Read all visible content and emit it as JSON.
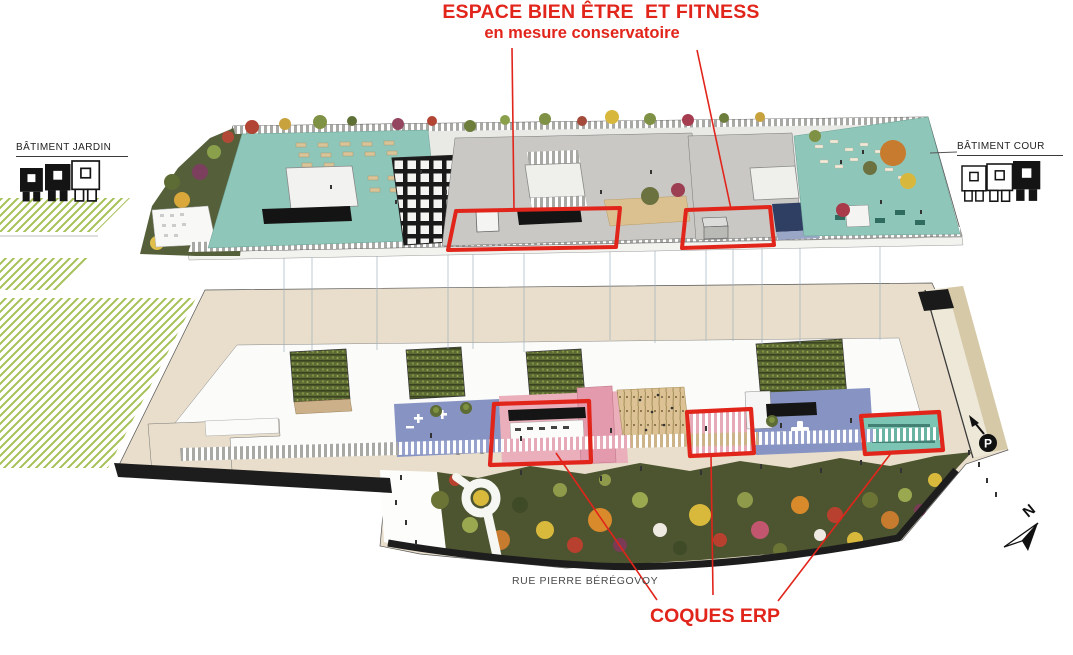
{
  "title": {
    "line1": "ESPACE BIEN ÊTRE  ET FITNESS",
    "line2": "en mesure conservatoire"
  },
  "buildings": {
    "left": "BÂTIMENT JARDIN",
    "right": "BÂTIMENT COUR"
  },
  "street_label": "RUE PIERRE BÉRÉGOVOY",
  "coques_label": "COQUES ERP",
  "compass": {
    "north": "N"
  },
  "parking": {
    "label": "P"
  },
  "colors": {
    "annotation_red": "#e1251b",
    "teal_terrace": "#8fc6ba",
    "gray_roof": "#c9c8c4",
    "plate_beige": "#e8decb",
    "blue_floor": "#8794c3",
    "pink_floor": "#eaafbb",
    "tan_floor": "#dcc294",
    "garden_green": "#4c5430",
    "hatch_green": "#a5c055",
    "blue_skylight": "#2f3e63"
  }
}
